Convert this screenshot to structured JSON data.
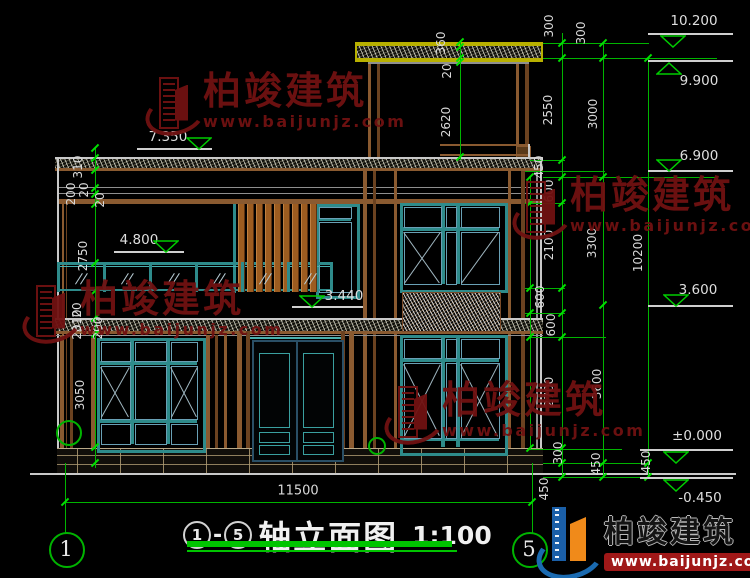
{
  "title": {
    "axis_from": "1",
    "dash": "-",
    "axis_to": "5",
    "name": "轴立面图",
    "scale": "1:100"
  },
  "axes": {
    "left": "1",
    "right": "5"
  },
  "levels": [
    {
      "text": "7.350",
      "tx": 168,
      "ty": 137,
      "lx1": 137,
      "lx2": 212,
      "ly": 148,
      "trix": 186,
      "mode": "above"
    },
    {
      "text": "4.800",
      "tx": 139,
      "ty": 240,
      "lx1": 114,
      "lx2": 184,
      "ly": 251,
      "trix": 153,
      "mode": "above"
    },
    {
      "text": "3.440",
      "tx": 344,
      "ty": 296,
      "lx1": 292,
      "lx2": 363,
      "ly": 306,
      "trix": 299,
      "mode": "above"
    },
    {
      "text": "10.200",
      "tx": 694,
      "ty": 21,
      "lx1": 648,
      "lx2": 733,
      "ly": 33,
      "trix": 660,
      "mode": "below"
    },
    {
      "text": "9.900",
      "tx": 699,
      "ty": 81,
      "lx1": 648,
      "lx2": 733,
      "ly": 60,
      "trix": 656,
      "mode": "up"
    },
    {
      "text": "6.900",
      "tx": 699,
      "ty": 156,
      "lx1": 648,
      "lx2": 733,
      "ly": 170,
      "trix": 656,
      "mode": "above"
    },
    {
      "text": "3.600",
      "tx": 698,
      "ty": 290,
      "lx1": 648,
      "lx2": 733,
      "ly": 305,
      "trix": 663,
      "mode": "above"
    },
    {
      "text": "±0.000",
      "tx": 697,
      "ty": 436,
      "lx1": 640,
      "lx2": 733,
      "ly": 449,
      "trix": 663,
      "mode": "below"
    },
    {
      "text": "-0.450",
      "tx": 700,
      "ty": 498,
      "lx1": 640,
      "lx2": 733,
      "ly": 477,
      "trix": 663,
      "mode": "below"
    }
  ],
  "dims_rotated": [
    {
      "t": "310",
      "x": 78,
      "y": 167
    },
    {
      "t": "200",
      "x": 71,
      "y": 194
    },
    {
      "t": "20",
      "x": 84,
      "y": 190
    },
    {
      "t": "20",
      "x": 100,
      "y": 200
    },
    {
      "t": "2750",
      "x": 83,
      "y": 256
    },
    {
      "t": "20",
      "x": 77,
      "y": 310
    },
    {
      "t": "310",
      "x": 77,
      "y": 321
    },
    {
      "t": "20",
      "x": 77,
      "y": 332
    },
    {
      "t": "200",
      "x": 98,
      "y": 328
    },
    {
      "t": "3050",
      "x": 80,
      "y": 395
    },
    {
      "t": "360",
      "x": 441,
      "y": 43
    },
    {
      "t": "20",
      "x": 447,
      "y": 71
    },
    {
      "t": "2620",
      "x": 446,
      "y": 122
    },
    {
      "t": "300",
      "x": 549,
      "y": 26
    },
    {
      "t": "2550",
      "x": 548,
      "y": 110
    },
    {
      "t": "450",
      "x": 539,
      "y": 167
    },
    {
      "t": "600",
      "x": 549,
      "y": 191
    },
    {
      "t": "2100",
      "x": 549,
      "y": 245
    },
    {
      "t": "600",
      "x": 540,
      "y": 297
    },
    {
      "t": "600",
      "x": 551,
      "y": 325
    },
    {
      "t": "2700",
      "x": 549,
      "y": 392
    },
    {
      "t": "300",
      "x": 558,
      "y": 453
    },
    {
      "t": "450",
      "x": 544,
      "y": 489
    },
    {
      "t": "300",
      "x": 581,
      "y": 33
    },
    {
      "t": "3000",
      "x": 593,
      "y": 114
    },
    {
      "t": "3300",
      "x": 592,
      "y": 243
    },
    {
      "t": "3600",
      "x": 597,
      "y": 384
    },
    {
      "t": "450",
      "x": 596,
      "y": 464
    },
    {
      "t": "10200",
      "x": 638,
      "y": 253
    },
    {
      "t": "450",
      "x": 646,
      "y": 462
    }
  ],
  "dims_horizontal": [
    {
      "t": "11500",
      "x": 298,
      "y": 491
    }
  ],
  "watermark": {
    "brand": "柏竣建筑",
    "url": "www.baijunjz.com",
    "positions": [
      [
        147,
        72
      ],
      [
        24,
        280
      ],
      [
        514,
        176
      ],
      [
        386,
        381
      ]
    ]
  },
  "logo": {
    "brand": "柏竣建筑",
    "url": "www.baijunjz.com"
  },
  "colors": {
    "background": "#000000",
    "dimension_green": "#00b400",
    "text_white": "#d9d9d9",
    "window_teal": "#2e8b8b",
    "wall_brown": "#8a5a30",
    "slab_yellow": "#b8b000",
    "watermark_red": "#701111",
    "logo_blue": "#1a5fa8",
    "logo_orange": "#f08a1a",
    "banner_red": "#a01818"
  }
}
